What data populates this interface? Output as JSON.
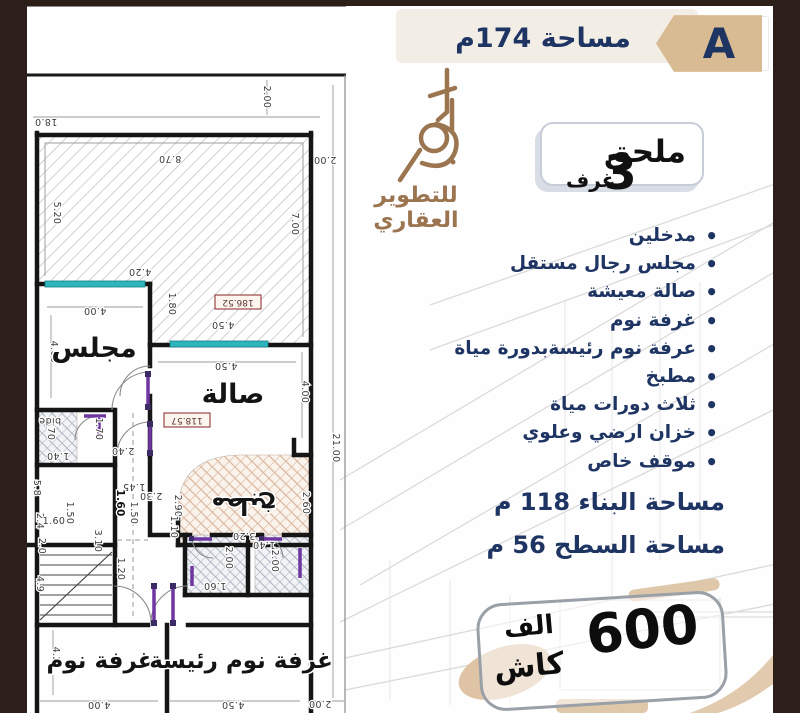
{
  "colors": {
    "frame_brown": "#2c1e18",
    "navy_text": "#1e3462",
    "badge_tan": "#d9bb93",
    "logo_brown": "#9b7450",
    "window_teal": "#2fb6bd",
    "door_purple": "#6f35a0",
    "tag_red": "#9c4747"
  },
  "header": {
    "area_label": "مساحة 174م",
    "badge_letter": "A"
  },
  "logo": {
    "text": "للتطوير العقاري"
  },
  "annex": {
    "title": "ملحق",
    "rooms_count": "3",
    "rooms_word": "غرف"
  },
  "features": {
    "items": [
      "مدخلين",
      "مجلس رجال مستقل",
      "صالة معيشة",
      "غرفة نوم",
      "عرفة نوم رئيسةبدورة مياة",
      "مطبخ",
      "ثلاث دورات مياة",
      "خزان ارضي وعلوي",
      "موقف خاص"
    ]
  },
  "areas": {
    "building": "مساحة البناء  118  م",
    "surface": "مساحة السطح  56  م"
  },
  "price": {
    "amount": "600",
    "unit": "الف",
    "method": "كاش"
  },
  "plan": {
    "rooms": [
      {
        "t": "مجلس",
        "x": 94,
        "y": 357,
        "s": 27,
        "r": 0
      },
      {
        "t": "صالة",
        "x": 233,
        "y": 403,
        "s": 27,
        "r": 0
      },
      {
        "t": "مطبخ",
        "x": 244,
        "y": 498,
        "s": 24,
        "r": 180
      },
      {
        "t": "غرفة نوم",
        "x": 100,
        "y": 668,
        "s": 23,
        "r": 0
      },
      {
        "t": "غرفة نوم رئيسة",
        "x": 241,
        "y": 668,
        "s": 23,
        "r": 0
      }
    ],
    "dims": [
      {
        "t": "18.0",
        "x": 46,
        "y": 119,
        "r": 180
      },
      {
        "t": "2.00",
        "x": 264,
        "y": 97,
        "r": 90
      },
      {
        "t": "2.00",
        "x": 325,
        "y": 157,
        "r": 180
      },
      {
        "t": "8.70",
        "x": 170,
        "y": 156,
        "r": 180
      },
      {
        "t": "5.20",
        "x": 54,
        "y": 213,
        "r": 90
      },
      {
        "t": "7.00",
        "x": 292,
        "y": 224,
        "r": 90
      },
      {
        "t": "4.20",
        "x": 140,
        "y": 269,
        "r": 180
      },
      {
        "t": "4.00",
        "x": 95,
        "y": 308,
        "r": 180
      },
      {
        "t": "1.80",
        "x": 169,
        "y": 304,
        "r": 90
      },
      {
        "t": "4.50",
        "x": 223,
        "y": 322,
        "r": 180
      },
      {
        "t": "4.50",
        "x": 226,
        "y": 363,
        "r": 180
      },
      {
        "t": "4.00",
        "x": 51,
        "y": 352,
        "r": 90
      },
      {
        "t": "4.00",
        "x": 302,
        "y": 392,
        "r": 90
      },
      {
        "t": "21.00",
        "x": 333,
        "y": 448,
        "r": 90
      },
      {
        "t": "1.70",
        "x": 48,
        "y": 429,
        "r": 90
      },
      {
        "t": "1.70",
        "x": 96,
        "y": 429,
        "r": 90
      },
      {
        "t": "1.40",
        "x": 58,
        "y": 453,
        "r": 180
      },
      {
        "t": "2.40",
        "x": 123,
        "y": 448,
        "r": 180
      },
      {
        "t": "2.30",
        "x": 151,
        "y": 493,
        "r": 180
      },
      {
        "t": "1.50",
        "x": 67,
        "y": 513,
        "r": 90
      },
      {
        "t": "1.50",
        "x": 131,
        "y": 513,
        "r": 90
      },
      {
        "t": "2.90",
        "x": 175,
        "y": 506,
        "r": 90
      },
      {
        "t": "1.10",
        "x": 171,
        "y": 527,
        "r": 90
      },
      {
        "t": "2.60",
        "x": 303,
        "y": 503,
        "r": 90
      },
      {
        "t": "3.20",
        "x": 244,
        "y": 533,
        "r": 180
      },
      {
        "t": "5.8",
        "x": 34,
        "y": 488,
        "r": 90
      },
      {
        "t": "2.4",
        "x": 37,
        "y": 521,
        "r": 90
      },
      {
        "t": "1.45",
        "x": 134,
        "y": 484,
        "r": 180
      },
      {
        "t": "1.60",
        "x": 117,
        "y": 503,
        "r": 90,
        "b": true
      },
      {
        "t": "1.60",
        "x": 54,
        "y": 524,
        "r": 0
      },
      {
        "t": "3.10",
        "x": 95,
        "y": 541,
        "r": 90
      },
      {
        "t": "2.0",
        "x": 39,
        "y": 546,
        "r": 90
      },
      {
        "t": "1.20",
        "x": 118,
        "y": 569,
        "r": 90
      },
      {
        "t": "4.9",
        "x": 37,
        "y": 584,
        "r": 90
      },
      {
        "t": "2.00",
        "x": 226,
        "y": 558,
        "r": 90
      },
      {
        "t": "1.60",
        "x": 215,
        "y": 583,
        "r": 180
      },
      {
        "t": "1.40",
        "x": 264,
        "y": 542,
        "r": 180
      },
      {
        "t": "2.00",
        "x": 272,
        "y": 561,
        "r": 90
      },
      {
        "t": "4.20",
        "x": 53,
        "y": 658,
        "r": 90
      },
      {
        "t": "4.00",
        "x": 99,
        "y": 702,
        "r": 180
      },
      {
        "t": "4.50",
        "x": 233,
        "y": 702,
        "r": 180
      },
      {
        "t": "2.00",
        "x": 320,
        "y": 701,
        "r": 180
      },
      {
        "t": "bide",
        "x": 50,
        "y": 418,
        "r": 180
      }
    ],
    "tags": [
      {
        "t": "118.57",
        "x": 187,
        "y": 421,
        "r": 180
      },
      {
        "t": "186.52",
        "x": 238,
        "y": 303,
        "r": 180
      }
    ]
  }
}
